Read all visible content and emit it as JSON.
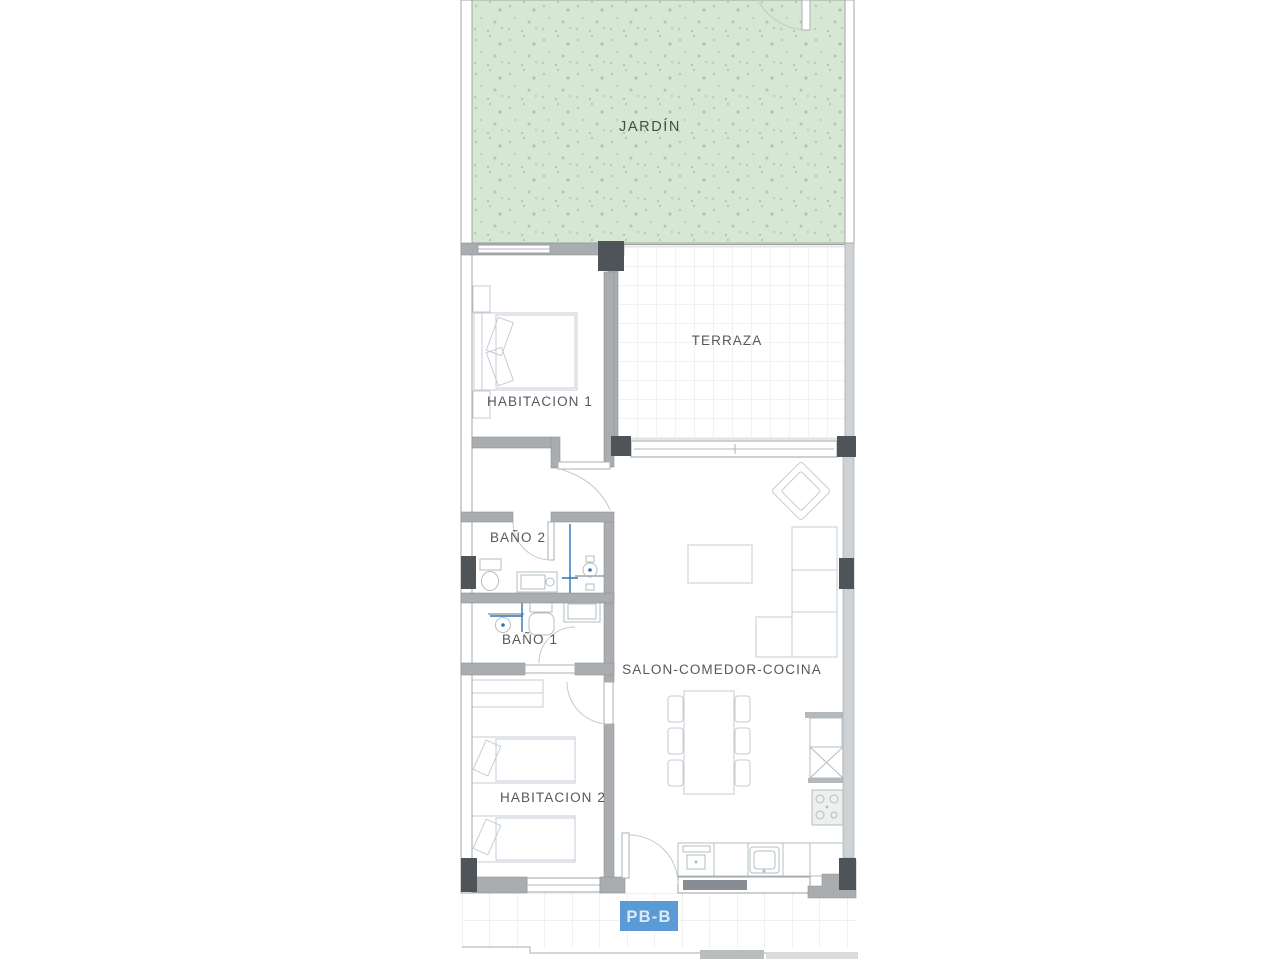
{
  "unit": {
    "badge": "PB-B"
  },
  "rooms": {
    "jardin": "JARDÍN",
    "terraza": "TERRAZA",
    "habitacion1": "HABITACION 1",
    "bano2": "BAÑO 2",
    "bano1": "BAÑO 1",
    "habitacion2": "HABITACION 2",
    "salon": "SALON-COMEDOR-COCINA"
  },
  "colors": {
    "garden_fill": "#d6e7d4",
    "garden_speckle": "#aecbac",
    "garden_label": "#46504a",
    "wall_gray": "#a9adb0",
    "wall_light": "#ced2d4",
    "pillar_dark": "#4e5458",
    "room_label": "#55585c",
    "plumbing_blue": "#2e74b5",
    "furniture_line": "#c4cdd4",
    "tile_line": "#e3e5e5",
    "badge_bg": "#5b9bd5",
    "badge_text": "#ddeaf8"
  }
}
